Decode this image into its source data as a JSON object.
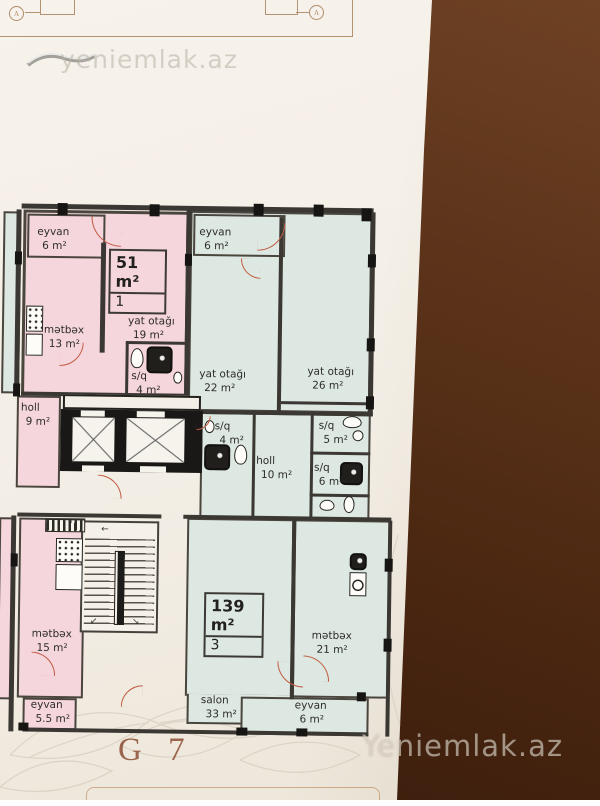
{
  "sheet": {
    "code": "G 7",
    "watermark_top": "yeniemlak.az",
    "watermark_bottom": "Yeniemlak.az",
    "axis_marker_left": "A",
    "axis_marker_right": "A"
  },
  "apartments": {
    "apt_51": {
      "area": "51 m²",
      "number": "1"
    },
    "apt_139": {
      "area": "139 m²",
      "number": "3"
    }
  },
  "rooms": {
    "apt51_eyvan": {
      "name": "eyvan",
      "area": "6 m²"
    },
    "apt51_metbex": {
      "name": "mətbəx",
      "area": "13 m²"
    },
    "apt51_yat_otagi": {
      "name": "yat otağı",
      "area": "19 m²"
    },
    "apt51_sq": {
      "name": "s/q",
      "area": "4 m²"
    },
    "apt51_holl": {
      "name": "holl",
      "area": "9 m²"
    },
    "apt139_eyvan_top": {
      "name": "eyvan",
      "area": "6 m²"
    },
    "apt139_yat_otagi_1": {
      "name": "yat otağı",
      "area": "22 m²"
    },
    "apt139_yat_otagi_2": {
      "name": "yat otağı",
      "area": "26 m²"
    },
    "apt139_sq_1": {
      "name": "s/q",
      "area": "4 m²"
    },
    "apt139_holl": {
      "name": "holl",
      "area": "10 m²"
    },
    "apt139_sq_2": {
      "name": "s/q",
      "area": "5 m²"
    },
    "apt139_sq_3": {
      "name": "s/q",
      "area": "6 m²"
    },
    "apt139_salon": {
      "name": "salon",
      "area": "33 m²"
    },
    "apt139_metbex": {
      "name": "mətbəx",
      "area": "21 m²"
    },
    "apt139_eyvan_bottom": {
      "name": "eyvan",
      "area": "6 m²"
    },
    "metbex_15": {
      "name": "mətbəx",
      "area": "15 m²"
    },
    "eyvan_55": {
      "name": "eyvan",
      "area": "5.5 m²"
    }
  },
  "colors": {
    "apartment_pink": "#f5d6dc",
    "apartment_green": "#dde8e2",
    "wall_dark": "#3b3834",
    "door_arc": "#c25a41",
    "sheet_code_text": "#8d4f35",
    "drawing_frame": "#a8835d"
  }
}
